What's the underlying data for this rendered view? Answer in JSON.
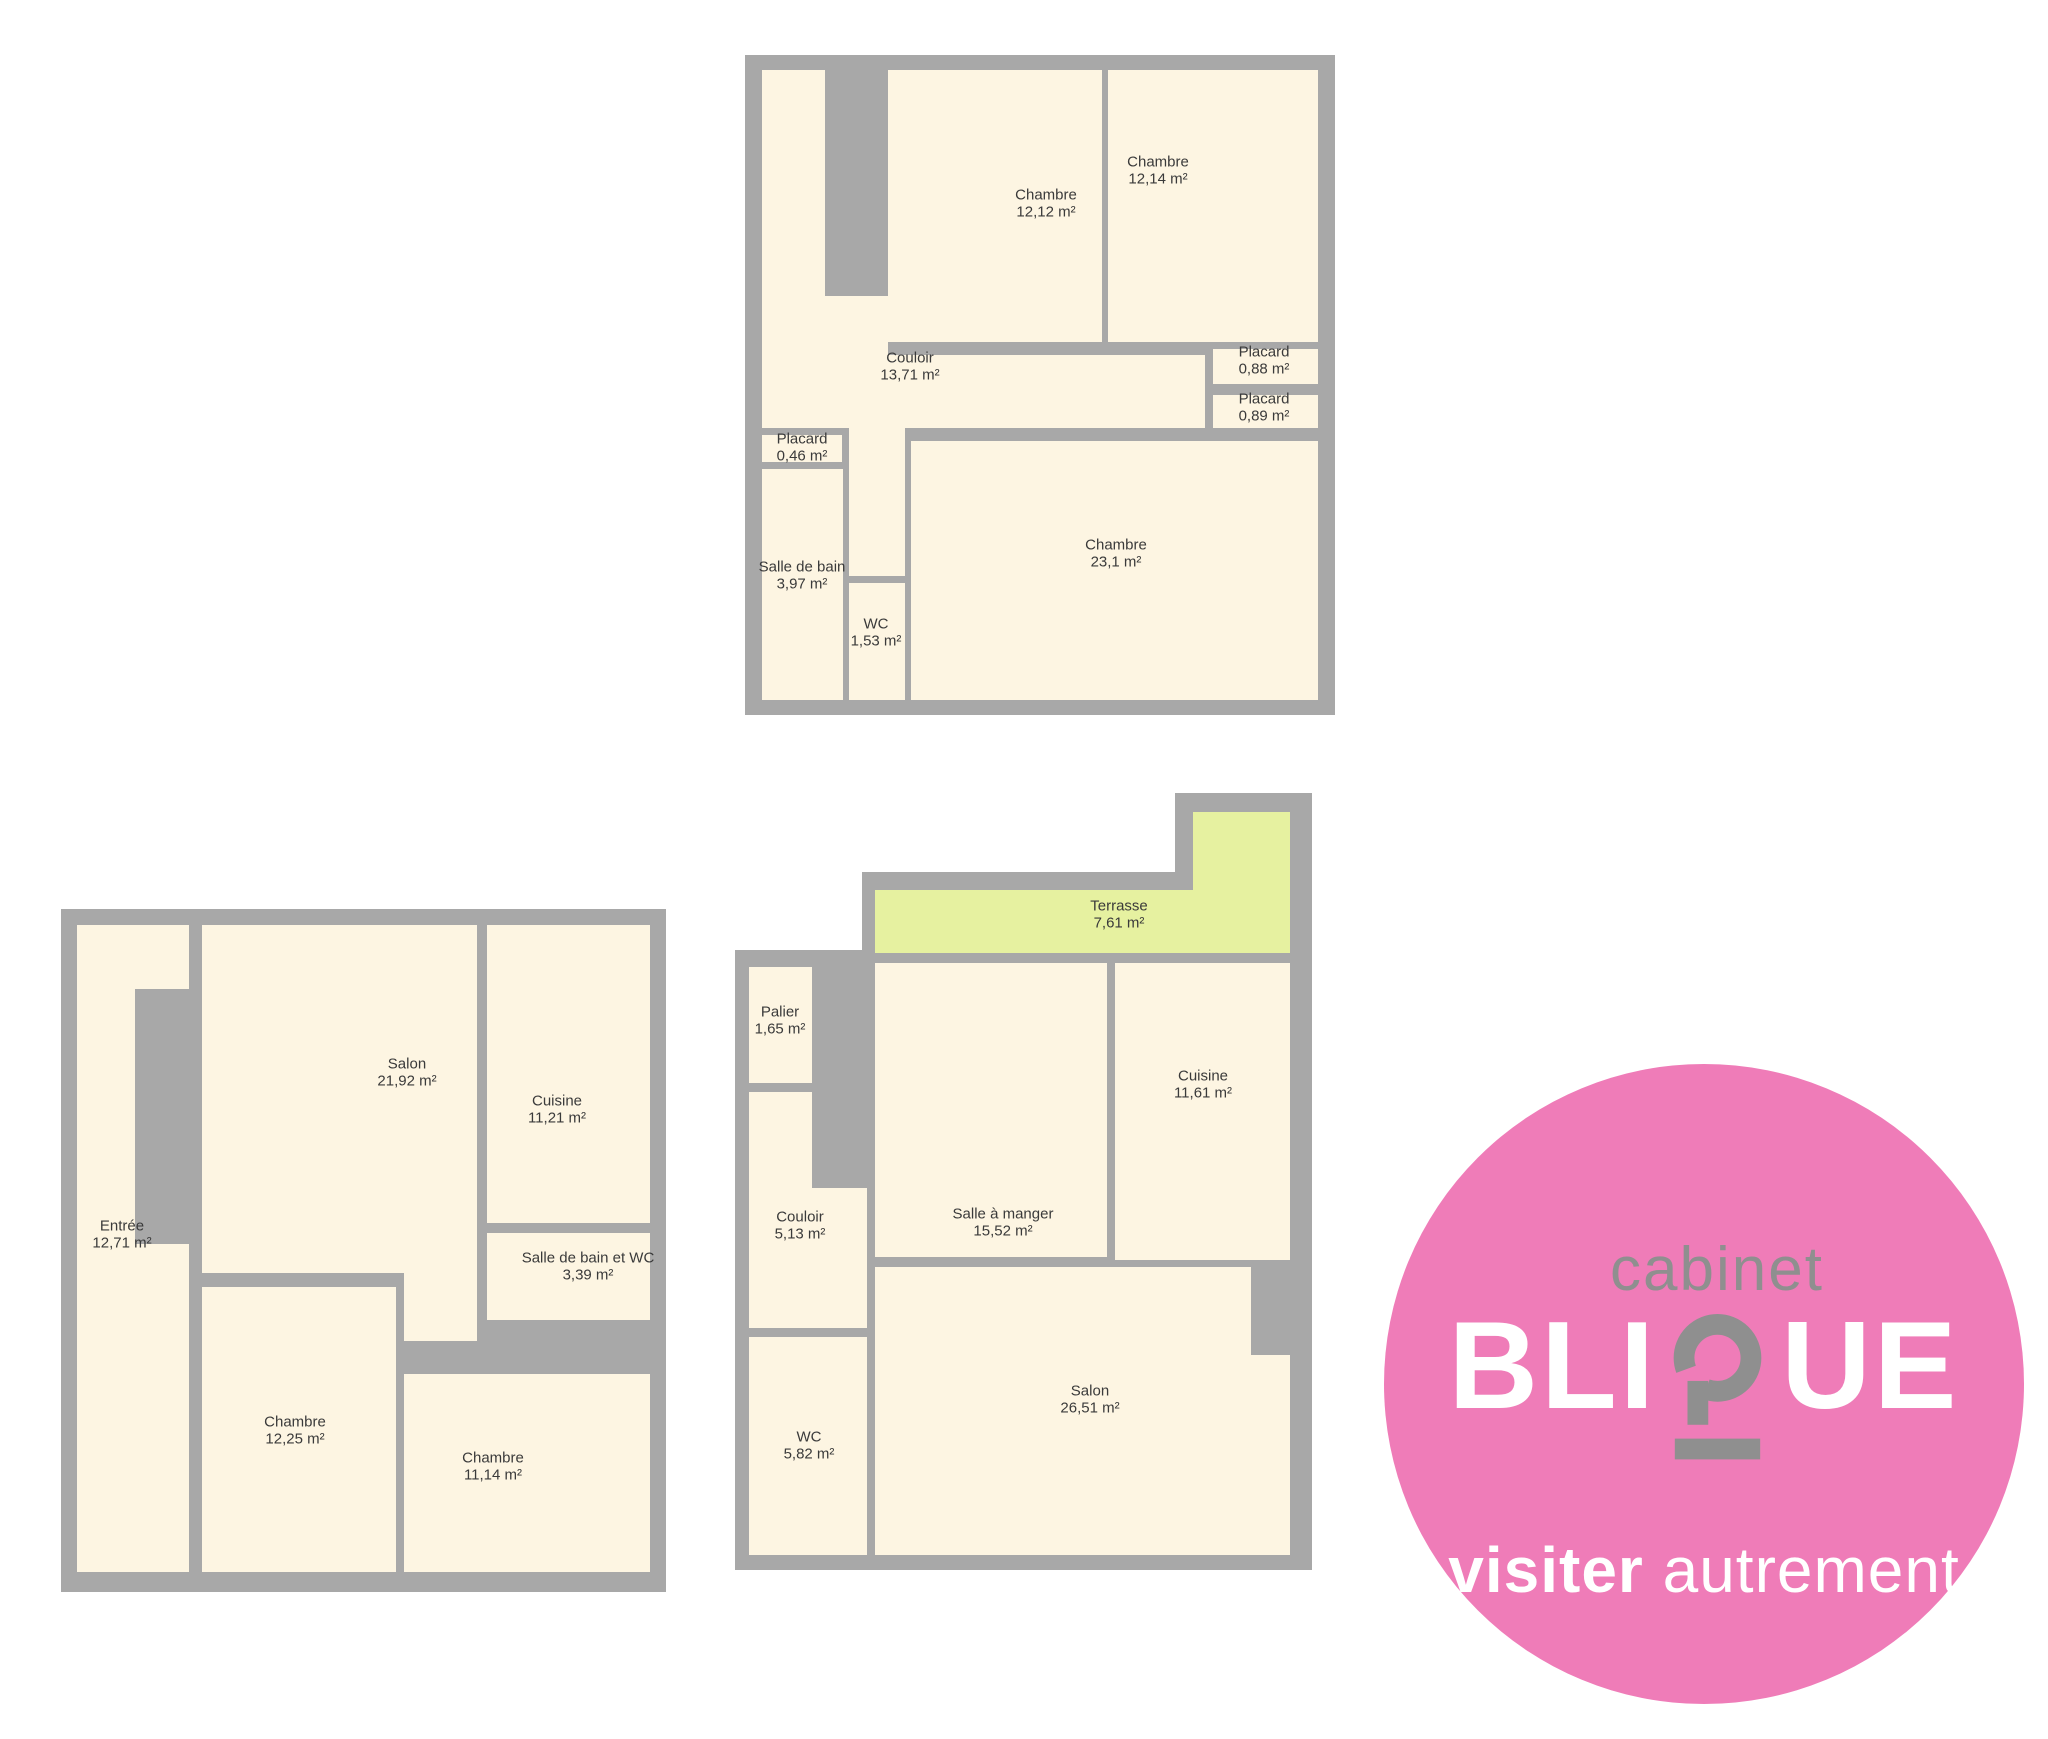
{
  "colors": {
    "wall": "#a8a8a8",
    "floor": "#fdf5e2",
    "terrace": "#e6f1a0",
    "pink": "#ef7cb8",
    "logo_gray": "#8f8f8f",
    "text": "#3a3a3a"
  },
  "plans": [
    {
      "id": "upper-floor",
      "rooms": [
        {
          "name": "Chambre",
          "area": "12,12 m²"
        },
        {
          "name": "Chambre",
          "area": "12,14 m²"
        },
        {
          "name": "Couloir",
          "area": "13,71 m²"
        },
        {
          "name": "Placard",
          "area": "0,88 m²"
        },
        {
          "name": "Placard",
          "area": "0,89 m²"
        },
        {
          "name": "Placard",
          "area": "0,46 m²"
        },
        {
          "name": "Salle de bain",
          "area": "3,97 m²"
        },
        {
          "name": "WC",
          "area": "1,53 m²"
        },
        {
          "name": "Chambre",
          "area": "23,1 m²"
        }
      ]
    },
    {
      "id": "ground-floor-left",
      "rooms": [
        {
          "name": "Salon",
          "area": "21,92 m²"
        },
        {
          "name": "Cuisine",
          "area": "11,21 m²"
        },
        {
          "name": "Salle de bain et WC",
          "area": "3,39 m²"
        },
        {
          "name": "Entrée",
          "area": "12,71 m²"
        },
        {
          "name": "Chambre",
          "area": "12,25 m²"
        },
        {
          "name": "Chambre",
          "area": "11,14 m²"
        }
      ]
    },
    {
      "id": "ground-floor-center",
      "rooms": [
        {
          "name": "Terrasse",
          "area": "7,61 m²"
        },
        {
          "name": "Palier",
          "area": "1,65 m²"
        },
        {
          "name": "Couloir",
          "area": "5,13 m²"
        },
        {
          "name": "Salle à manger",
          "area": "15,52 m²"
        },
        {
          "name": "Cuisine",
          "area": "11,61 m²"
        },
        {
          "name": "Salon",
          "area": "26,51 m²"
        },
        {
          "name": "WC",
          "area": "5,82 m²"
        }
      ]
    }
  ],
  "logo": {
    "cabinet": "cabinet",
    "brand_pre": "BLI",
    "brand_post": "UE",
    "tagline_bold": "visiter",
    "tagline_light": "autrement"
  }
}
